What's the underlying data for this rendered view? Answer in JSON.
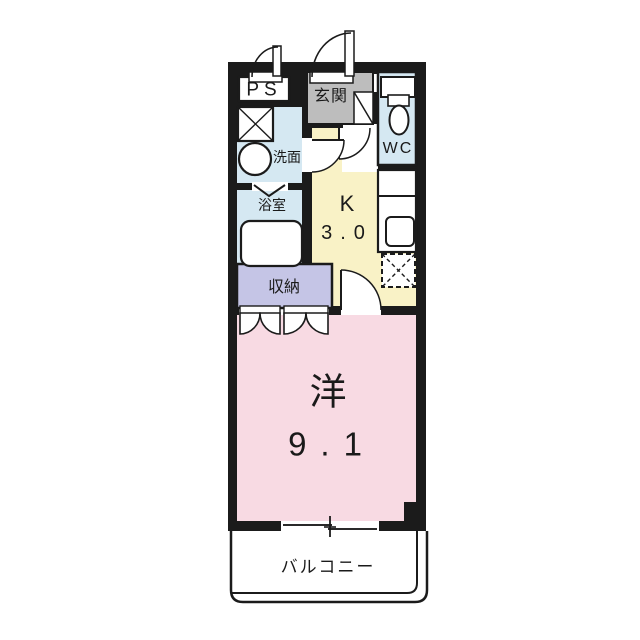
{
  "floorplan": {
    "rooms": {
      "ps": {
        "label": "PS"
      },
      "entrance": {
        "label": "玄関"
      },
      "wc": {
        "label": "WC"
      },
      "washroom": {
        "label": "洗面"
      },
      "bathroom": {
        "label": "浴室"
      },
      "storage": {
        "label": "収納"
      },
      "kitchen": {
        "label": "K",
        "size": "3.0"
      },
      "western_room": {
        "label": "洋",
        "size": "9.1"
      },
      "balcony": {
        "label": "バルコニー"
      }
    },
    "colors": {
      "wall": "#1b1b1b",
      "entrance_floor": "#bdbdbd",
      "wet_area_blue": "#d5e8f2",
      "kitchen_yellow": "#f9f2c6",
      "storage_lavender": "#c5c5e6",
      "room_pink": "#f8dae3",
      "white": "#ffffff"
    }
  }
}
